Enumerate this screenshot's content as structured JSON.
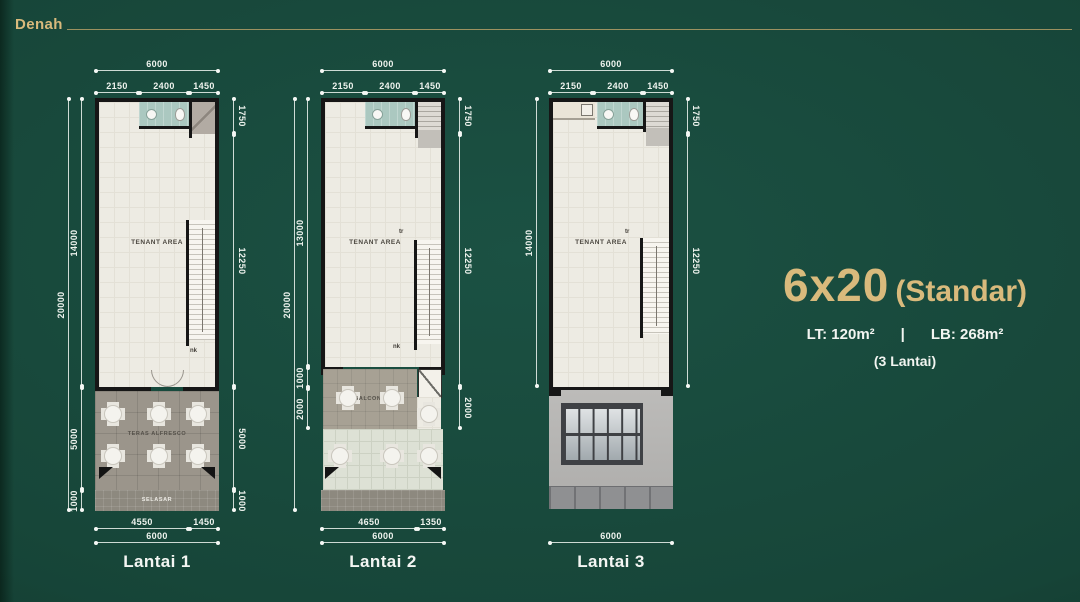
{
  "header": {
    "title": "Denah"
  },
  "info": {
    "size": "6x20",
    "variant": "(Standar)",
    "lt": "LT: 120m²",
    "separator": "|",
    "lb": "LB: 268m²",
    "floors": "(3 Lantai)"
  },
  "plans": [
    {
      "label": "Lantai 1",
      "rooms": {
        "tenant": "TENANT AREA",
        "terrace": "TERAS ALFRESCO",
        "corridor": "SELASAR",
        "stair_down": "nk"
      },
      "dims": {
        "top_total": "6000",
        "top": [
          "2150",
          "2400",
          "1450"
        ],
        "left_outer": "20000",
        "left": [
          "14000",
          "5000",
          "1000"
        ],
        "right": [
          "1750",
          "12250",
          "5000",
          "1000"
        ],
        "bottom": [
          "4550",
          "1450"
        ],
        "bottom_total": "6000"
      }
    },
    {
      "label": "Lantai 2",
      "rooms": {
        "tenant": "TENANT AREA",
        "balcony": "BALCONY",
        "stair_up": "tr",
        "stair_down": "nk"
      },
      "dims": {
        "top_total": "6000",
        "top": [
          "2150",
          "2400",
          "1450"
        ],
        "left_outer": "20000",
        "left": [
          "13000",
          "1000",
          "2000"
        ],
        "right": [
          "1750",
          "12250",
          "2000"
        ],
        "bottom": [
          "4650",
          "1350"
        ],
        "bottom_total": "6000"
      }
    },
    {
      "label": "Lantai 3",
      "rooms": {
        "tenant": "TENANT AREA",
        "stair_up": "tr"
      },
      "dims": {
        "top_total": "6000",
        "top": [
          "2150",
          "2400",
          "1450"
        ],
        "left": [
          "14000"
        ],
        "right": [
          "1750",
          "12250"
        ],
        "bottom_total": "6000"
      }
    }
  ],
  "colors": {
    "background": "#174639",
    "accent_gold": "#d9ba7c",
    "text_white": "#f2f5f1",
    "wall": "#161616",
    "bathroom": "#abc8c0",
    "floor": "#edebe3"
  }
}
